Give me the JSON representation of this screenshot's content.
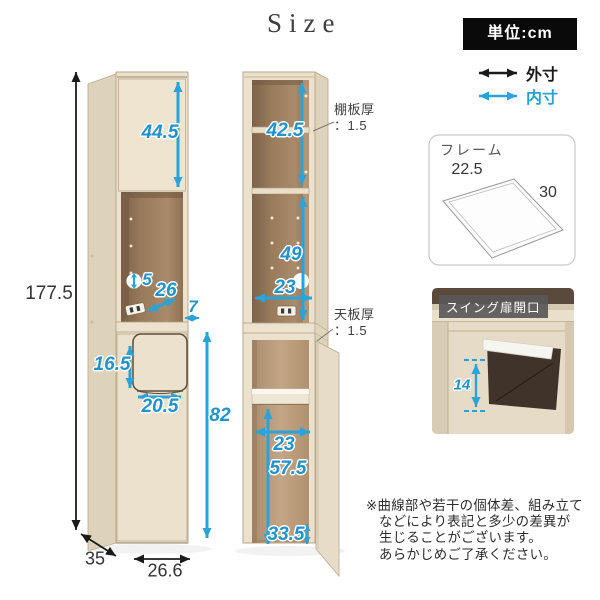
{
  "title": "Size",
  "legend": {
    "unit": "単位:cm",
    "outer": "外寸",
    "inner": "内寸"
  },
  "colors": {
    "accent_blue": "#29a3d9",
    "arrow_black": "#1a1a1a",
    "wood_front": "#ebe1cc",
    "wood_side": "#ddd2ba",
    "interior_dark": "#937557",
    "interior_light": "#bfa283",
    "unit_box_bg": "#0a0a0a",
    "swing_label_bg": "#585858"
  },
  "left_cabinet": {
    "total_height": "177.5",
    "upper_door_inner_height": "44.5",
    "shelf_pitch": "5",
    "niche_depth": "26",
    "counter_overhang": "7",
    "flip_door_height": "16.5",
    "flip_door_width": "20.5",
    "lower_section_height": "82",
    "depth": "35",
    "width": "26.6"
  },
  "middle_cabinet": {
    "upper_inner_height": "42.5",
    "shelf_thickness_label": "棚板厚",
    "shelf_thickness_value": "：1.5",
    "middle_inner_height": "49",
    "middle_inner_width": "23",
    "top_board_label": "天板厚",
    "top_board_value": "：1.5",
    "lower_inner_width": "23",
    "lower_inner_height": "57.5",
    "lower_door_opening": "33.5"
  },
  "frame_panel": {
    "title": "フレーム",
    "width": "22.5",
    "depth": "30"
  },
  "swing_panel": {
    "title": "スイング扉開口",
    "opening_height": "14"
  },
  "disclaimer": {
    "lines": [
      "※曲線部や若干の個体差、組み立て",
      "などにより表記と多少の差異が",
      "生じることがございます。",
      "あらかじめご了承ください。"
    ]
  }
}
